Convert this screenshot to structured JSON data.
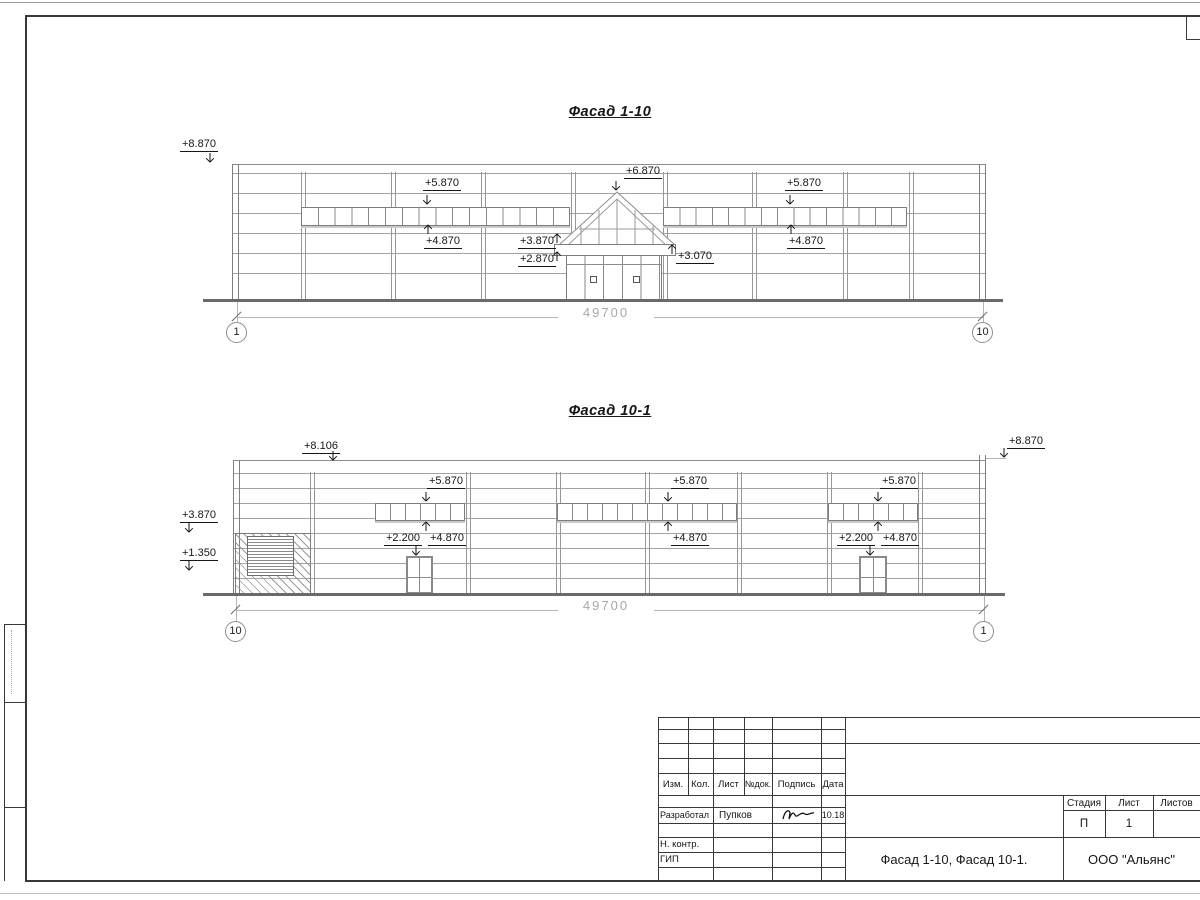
{
  "drawing": {
    "facade1": {
      "title": "Фасад 1-10",
      "length_dim": "49700",
      "axis_left": "1",
      "axis_right": "10",
      "marks": {
        "parapet": "+8.870",
        "win1_top": "+5.870",
        "win1_bottom": "+4.870",
        "entry_top": "+6.870",
        "canopy_top": "+3.870",
        "canopy_bottom": "+2.870",
        "canopy_right": "+3.070",
        "win2_top": "+5.870",
        "win2_bottom": "+4.870"
      }
    },
    "facade2": {
      "title": "Фасад 10-1",
      "length_dim": "49700",
      "axis_left": "10",
      "axis_right": "1",
      "marks": {
        "parapet_left": "+8.106",
        "parapet_right": "+8.870",
        "unit_top": "+3.870",
        "unit_bottom": "+1.350",
        "s1_top": "+5.870",
        "s1_bottom": "+4.870",
        "door1_top": "+2.200",
        "s2_top": "+5.870",
        "s2_bottom": "+4.870",
        "s3_top": "+5.870",
        "s3_bottom": "+4.870",
        "door2_top": "+2.200"
      }
    },
    "titleblock": {
      "rev_headers": [
        "Изм.",
        "Кол.",
        "Лист",
        "№док.",
        "Подпись",
        "Дата"
      ],
      "rows": [
        {
          "role": "Разработал",
          "name": "Пупков",
          "date": "10.18"
        },
        {
          "role": "Н. контр.",
          "name": "",
          "date": ""
        },
        {
          "role": "ГИП",
          "name": "",
          "date": ""
        }
      ],
      "stage_header": "Стадия",
      "sheet_header": "Лист",
      "sheets_header": "Листов",
      "stage": "П",
      "sheet": "1",
      "sheets": "",
      "doc_name": "Фасад 1-10, Фасад 10-1.",
      "organization": "ООО \"Альянс\""
    }
  }
}
